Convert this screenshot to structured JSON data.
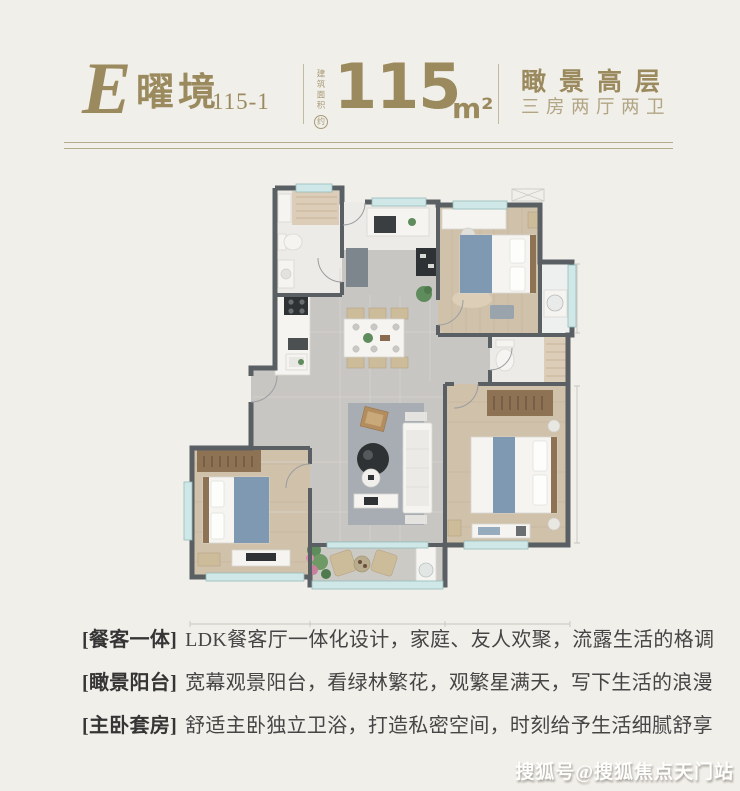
{
  "page": {
    "background": "#f1efea",
    "accent_gold": "#9a8a5e",
    "accent_gold_light": "#b2a584",
    "text_dark": "#454545"
  },
  "header": {
    "logo_letter": "E",
    "logo_name": "曜境",
    "logo_code": "115-1",
    "area_label": "建筑面积",
    "area_approx": "约",
    "area_value": "115",
    "area_unit": "m²",
    "tagline_primary": "瞰景高层",
    "tagline_secondary": "三房两厅两卫"
  },
  "features": [
    {
      "tag": "[餐客一体]",
      "text": "LDK餐客厅一体化设计，家庭、友人欢聚，流露生活的格调"
    },
    {
      "tag": "[瞰景阳台]",
      "text": "宽幕观景阳台，看绿林繁花，观繁星满天，写下生活的浪漫"
    },
    {
      "tag": "[主卧套房]",
      "text": "舒适主卧独立卫浴，打造私密空间，时刻给予生活细腻舒享"
    }
  ],
  "watermark": {
    "text": "搜狐号@搜狐焦点天门站"
  },
  "floor_plan": {
    "palette": {
      "wall": "#5a5f63",
      "tile": "#c8c6c2",
      "wood": "#d0c1aa",
      "marble": "#edebe7",
      "window": "#cfe8e7",
      "rug": "#a7adb2",
      "bed_blue": "#8099b2",
      "wardrobe": "#8d7354",
      "green": "#5f8c5c"
    }
  }
}
